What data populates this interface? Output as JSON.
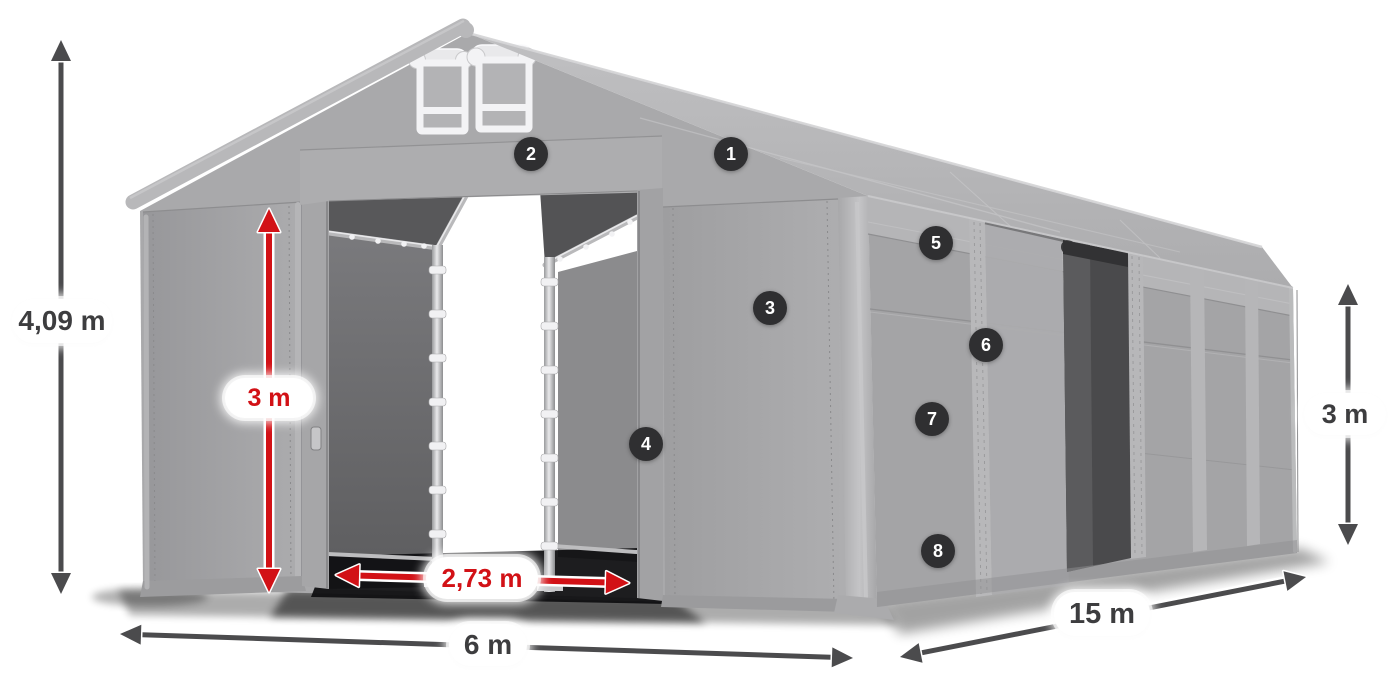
{
  "colors": {
    "badge_bg": "#2f2f31",
    "badge_text": "#ffffff",
    "arrow_dark": "#4b4b4d",
    "arrow_red": "#d21116",
    "pill_bg": "#ffffff",
    "pill_text_dark": "#3d3d3f",
    "pill_text_red": "#d21116"
  },
  "badges": [
    {
      "label": "1",
      "x": 731,
      "y": 154
    },
    {
      "label": "2",
      "x": 531,
      "y": 154
    },
    {
      "label": "3",
      "x": 770,
      "y": 308
    },
    {
      "label": "4",
      "x": 646,
      "y": 444
    },
    {
      "label": "5",
      "x": 936,
      "y": 243
    },
    {
      "label": "6",
      "x": 986,
      "y": 345
    },
    {
      "label": "7",
      "x": 932,
      "y": 419
    },
    {
      "label": "8",
      "x": 938,
      "y": 551
    }
  ],
  "dimensions": [
    {
      "name": "total-height",
      "label": "4,09 m",
      "style": "dark",
      "x1": 61,
      "y1": 40,
      "x2": 61,
      "y2": 594,
      "label_x": 62,
      "label_y": 321,
      "pill_w": 100,
      "pill_h": 44,
      "font": 28
    },
    {
      "name": "door-height",
      "label": "3 m",
      "style": "red",
      "x1": 269,
      "y1": 209,
      "x2": 269,
      "y2": 592,
      "label_x": 269,
      "label_y": 398,
      "pill_w": 88,
      "pill_h": 40,
      "font": 25
    },
    {
      "name": "door-width",
      "label": "2,73 m",
      "style": "red",
      "x1": 336,
      "y1": 575,
      "x2": 629,
      "y2": 583,
      "label_x": 482,
      "label_y": 578,
      "pill_w": 112,
      "pill_h": 42,
      "font": 26
    },
    {
      "name": "front-width",
      "label": "6 m",
      "style": "dark",
      "x1": 120,
      "y1": 634,
      "x2": 853,
      "y2": 658,
      "label_x": 488,
      "label_y": 645,
      "pill_w": 78,
      "pill_h": 42,
      "font": 28
    },
    {
      "name": "side-length",
      "label": "15 m",
      "style": "dark",
      "x1": 900,
      "y1": 657,
      "x2": 1306,
      "y2": 577,
      "label_x": 1102,
      "label_y": 614,
      "pill_w": 96,
      "pill_h": 44,
      "font": 29
    },
    {
      "name": "side-height",
      "label": "3 m",
      "style": "dark",
      "x1": 1348,
      "y1": 284,
      "x2": 1348,
      "y2": 545,
      "label_x": 1345,
      "label_y": 414,
      "pill_w": 82,
      "pill_h": 42,
      "font": 27
    }
  ]
}
